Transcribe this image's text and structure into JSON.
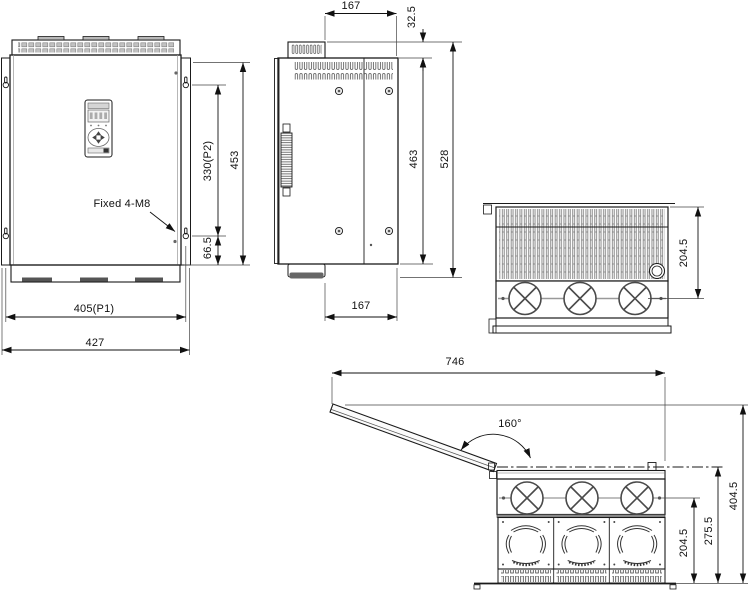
{
  "drawing": {
    "front_view": {
      "fixed_label": "Fixed 4-M8",
      "mount_height": "330(P2)",
      "overall_height": "453",
      "bottom_hole_offset": "66.5",
      "mount_width": "405(P1)",
      "overall_width": "427"
    },
    "side_view": {
      "top_depth": "167",
      "cap_offset": "32.5",
      "body_height": "463",
      "overall_height": "528",
      "bottom_depth": "167"
    },
    "top_view": {
      "depth_to_fan": "204.5"
    },
    "open_view": {
      "open_width": "746",
      "open_angle": "160°",
      "fan_center_height": "204.5",
      "body_top_height": "275.5",
      "open_total_height": "404.5"
    },
    "colors": {
      "line": "#1a1a1a",
      "background": "#ffffff"
    }
  }
}
